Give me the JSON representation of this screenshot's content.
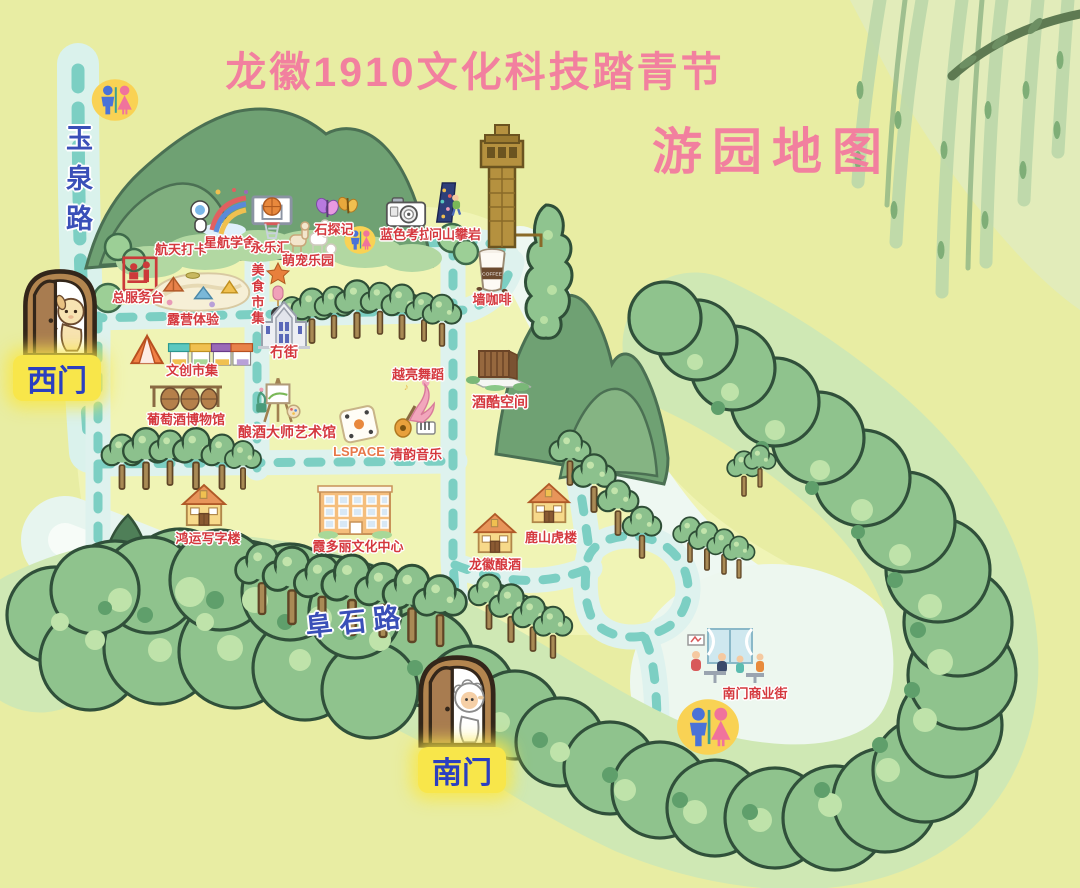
{
  "title": "龙徽1910文化科技踏青节",
  "subtitle": "游园地图",
  "colors": {
    "title_pink": "#f2809f",
    "poi_label_red": "#d5383e",
    "road_label_blue": "#3a4fb8",
    "gate_highlight_yellow": "#f8e64a",
    "path_teal_dash": "#7ccfc3",
    "background_green": "#e8eda3"
  },
  "roads": {
    "yuquan": {
      "label": "玉泉路",
      "orientation": "vertical"
    },
    "fushi": {
      "label": "阜石路",
      "orientation": "horizontal"
    }
  },
  "gates": [
    {
      "id": "west",
      "label": "西门",
      "door_x": 60,
      "door_y": 312,
      "w": 82,
      "label_x": 57,
      "label_y": 378,
      "icon": "puppy-door"
    },
    {
      "id": "south",
      "label": "南门",
      "door_x": 457,
      "door_y": 700,
      "w": 86,
      "label_x": 462,
      "label_y": 770,
      "icon": "sheep-door"
    }
  ],
  "restrooms": [
    {
      "id": "restroom-northwest",
      "x": 115,
      "y": 100,
      "size": 48
    },
    {
      "id": "restroom-central",
      "x": 360,
      "y": 240,
      "size": 32
    },
    {
      "id": "restroom-south",
      "x": 708,
      "y": 727,
      "size": 64
    }
  ],
  "landmarks": [
    {
      "id": "water-tower",
      "x": 502,
      "y": 185
    }
  ],
  "pois": [
    {
      "id": "hangtian-daka",
      "label": "航天打卡",
      "x": 181,
      "y": 239,
      "icon": "space-playground",
      "icon_x": 220,
      "icon_y": 186,
      "icon_w": 64
    },
    {
      "id": "xinghang-xueshe",
      "label": "星航学舍",
      "x": 230,
      "y": 232
    },
    {
      "id": "yongle-hui",
      "label": "永乐汇",
      "x": 270,
      "y": 237,
      "icon": "basketball-hoop",
      "icon_x": 272,
      "icon_y": 194,
      "icon_w": 44
    },
    {
      "id": "shitanji",
      "label": "石探记",
      "x": 334,
      "y": 219,
      "icon": "butterflies",
      "icon_x": 336,
      "icon_y": 196,
      "icon_w": 42
    },
    {
      "id": "mengchong-leyuan",
      "label": "萌宠乐园",
      "x": 308,
      "y": 250,
      "icon": "alpacas",
      "icon_x": 311,
      "icon_y": 221,
      "icon_w": 46
    },
    {
      "id": "lanse-kaola",
      "label": "蓝色考拉",
      "x": 406,
      "y": 224,
      "icon": "camera",
      "icon_x": 406,
      "icon_y": 196,
      "icon_w": 42
    },
    {
      "id": "wenshan-panyan",
      "label": "问山攀岩",
      "x": 455,
      "y": 224,
      "icon": "climbing-wall",
      "icon_x": 447,
      "icon_y": 181,
      "icon_w": 28
    },
    {
      "id": "qiang-kafei",
      "label": "墙咖啡",
      "x": 492,
      "y": 289,
      "icon": "coffee-cup",
      "icon_x": 492,
      "icon_y": 246,
      "icon_w": 33,
      "icon_text": "COFFEE"
    },
    {
      "id": "zong-fuwutai",
      "label": "总服务台",
      "x": 138,
      "y": 287,
      "icon": "service-desk",
      "icon_x": 140,
      "icon_y": 256,
      "icon_w": 36
    },
    {
      "id": "luying-tiyan",
      "label": "露营体验",
      "x": 193,
      "y": 309,
      "icon": "camping-area",
      "icon_x": 200,
      "icon_y": 260,
      "icon_w": 112
    },
    {
      "id": "meishi-shiji",
      "label": "美食市集",
      "x": 257,
      "y": 263,
      "vertical": true,
      "icon": "food-stack",
      "icon_x": 278,
      "icon_y": 261,
      "icon_w": 26
    },
    {
      "id": "mao-jie",
      "label": "冇街",
      "x": 284,
      "y": 342,
      "size": 14,
      "icon": "maojie-church",
      "icon_x": 284,
      "icon_y": 300,
      "icon_w": 56
    },
    {
      "id": "wenchuang-shiji",
      "label": "文创市集",
      "x": 192,
      "y": 360,
      "icon": "market-tent-stalls",
      "icon_x": 190,
      "icon_y": 330,
      "icon_w": 126
    },
    {
      "id": "putaojiu-bowuguan",
      "label": "葡萄酒博物馆",
      "x": 186,
      "y": 409,
      "icon": "wine-barrels",
      "icon_x": 186,
      "icon_y": 377,
      "icon_w": 80
    },
    {
      "id": "niangjiu-dashi",
      "label": "酿酒大师艺术馆",
      "x": 287,
      "y": 422,
      "size": 14,
      "icon": "art-easel",
      "icon_x": 278,
      "icon_y": 372,
      "icon_w": 44
    },
    {
      "id": "lspace",
      "label": "LSPACE",
      "x": 359,
      "y": 444,
      "color": "#e8784a",
      "icon": "dice",
      "icon_x": 360,
      "icon_y": 402,
      "icon_w": 52
    },
    {
      "id": "qingyun-yinyue",
      "label": "清韵音乐",
      "x": 416,
      "y": 444,
      "icon": "music-duo",
      "icon_x": 415,
      "icon_y": 404,
      "icon_w": 44
    },
    {
      "id": "yueliang-wudao",
      "label": "越亮舞蹈",
      "x": 418,
      "y": 364,
      "icon": "dancer",
      "icon_x": 421,
      "icon_y": 377,
      "icon_w": 38
    },
    {
      "id": "jiuku-kongjian",
      "label": "酒酷空间",
      "x": 500,
      "y": 392,
      "size": 14,
      "icon": "modern-building",
      "icon_x": 499,
      "icon_y": 347,
      "icon_w": 68
    },
    {
      "id": "hongyun-xiezilou",
      "label": "鸿运写字楼",
      "x": 208,
      "y": 528,
      "icon": "house",
      "icon_x": 204,
      "icon_y": 483,
      "icon_w": 42
    },
    {
      "id": "xiaduoli-center",
      "label": "霞多丽文化中心",
      "x": 358,
      "y": 536,
      "icon": "culture-center",
      "icon_x": 355,
      "icon_y": 482,
      "icon_w": 78
    },
    {
      "id": "longhui-niangjiu",
      "label": "龙徽酿酒",
      "x": 495,
      "y": 554,
      "icon": "house",
      "icon_x": 495,
      "icon_y": 512,
      "icon_w": 40
    },
    {
      "id": "lushan-hulou",
      "label": "鹿山虎楼",
      "x": 551,
      "y": 527,
      "icon": "house",
      "icon_x": 549,
      "icon_y": 482,
      "icon_w": 40
    },
    {
      "id": "nanmen-shangyejie",
      "label": "南门商业街",
      "x": 755,
      "y": 683,
      "icon": "street-scene",
      "icon_x": 728,
      "icon_y": 625,
      "icon_w": 92
    }
  ]
}
